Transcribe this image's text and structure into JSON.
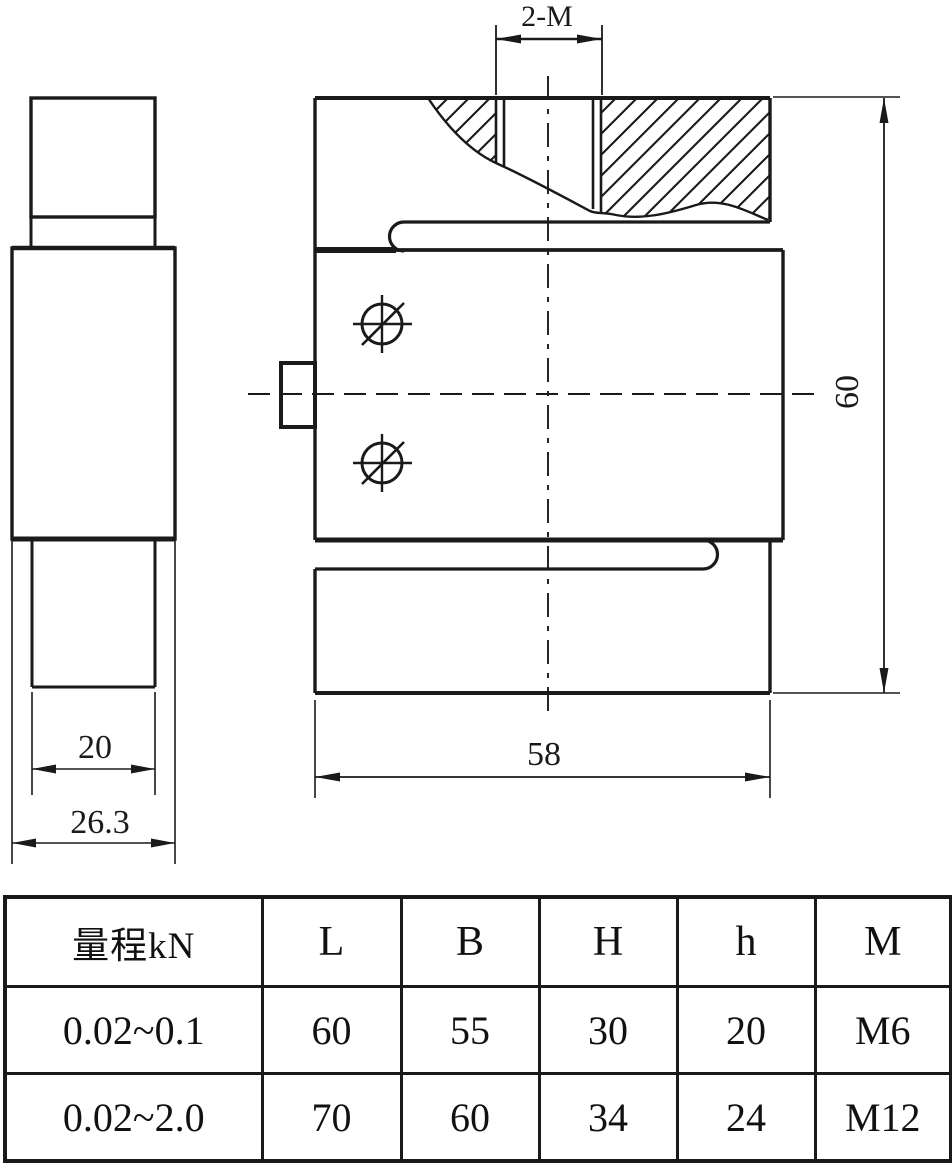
{
  "drawing": {
    "front_view": {
      "thread_label": "2-M",
      "height_dim": "60",
      "width_dim": "58"
    },
    "side_view": {
      "inner_width_dim": "20",
      "outer_width_dim": "26.3"
    }
  },
  "table": {
    "headers": [
      "量程kN",
      "L",
      "B",
      "H",
      "h",
      "M"
    ],
    "rows": [
      [
        "0.02~0.1",
        "60",
        "55",
        "30",
        "20",
        "M6"
      ],
      [
        "0.02~2.0",
        "70",
        "60",
        "34",
        "24",
        "M12"
      ]
    ]
  },
  "colors": {
    "line": "#1a1a1a",
    "background": "#ffffff"
  }
}
